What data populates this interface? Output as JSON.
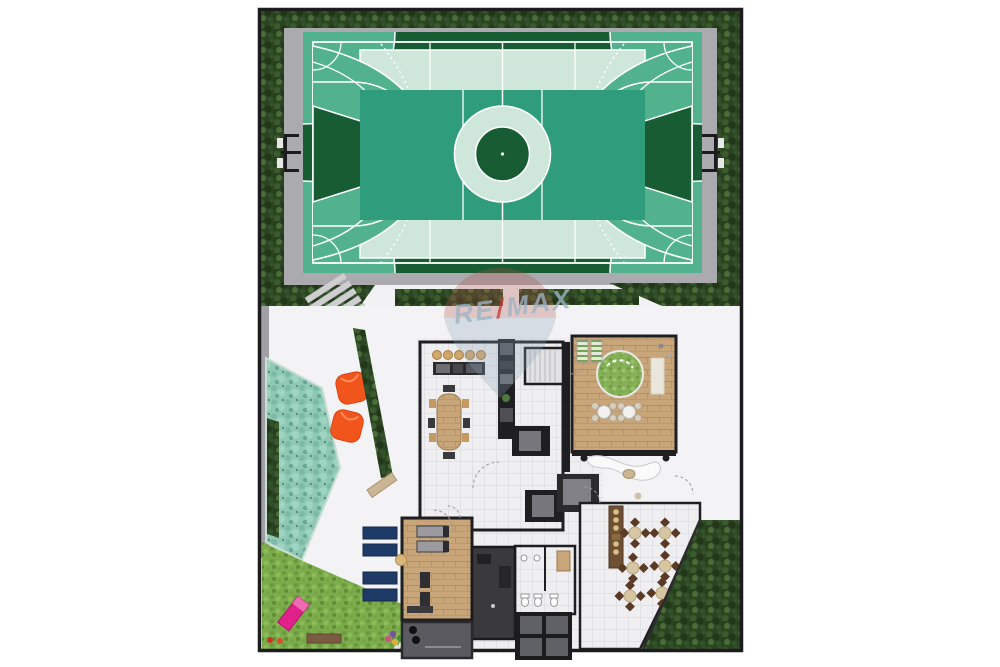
{
  "watermark": {
    "re": "RE",
    "slash": "/",
    "max": "MAX"
  },
  "palette": {
    "frame": "#1c1c1e",
    "path_gray": "#ababaf",
    "walk_white": "#f2f2f4",
    "plaza": "#f3f3f5",
    "court_dark": "#175c33",
    "court_mid": "#2f9d7b",
    "court_light": "#53b28e",
    "court_mint": "#cfe6da",
    "line_white": "#ffffff",
    "wall": "#1f1f22",
    "pool": "#8fc9b6",
    "lawn": "#7cab4b",
    "wood": "#c9a67a",
    "orange_beanbag": "#f2551c",
    "navy_lounger": "#1e3a66",
    "pink_lounger": "#e0218a",
    "table_brown": "#6b4226",
    "chair_brown": "#5a3a24",
    "deck_green": "#7fae5c",
    "beige": "#d2a86a",
    "stone": "#cbb694",
    "equip_gray": "#9a9aa0",
    "dark_room": "#3a3a3e",
    "annex_gray": "#5a5a60",
    "skylight_pane": "#5f5f66",
    "watermark_text": "#9db4c6",
    "watermark_red": "#bf4138",
    "balloon_top": "#b05048",
    "balloon_bottom": "#8ba2b5"
  }
}
